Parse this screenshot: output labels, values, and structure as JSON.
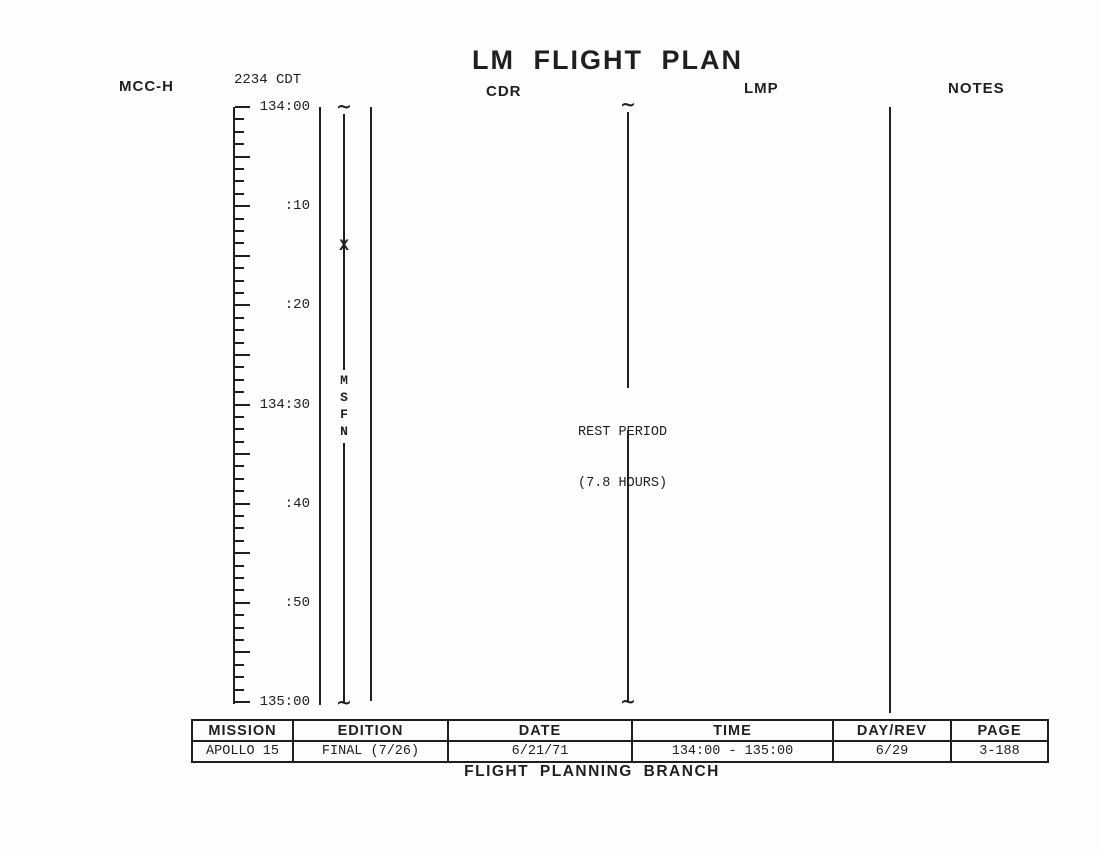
{
  "title": "LM FLIGHT PLAN",
  "header": {
    "mcch_label": "MCC-H",
    "local_time": "2234 CDT",
    "cdr_label": "CDR",
    "lmp_label": "LMP",
    "notes_label": "NOTES"
  },
  "timeline": {
    "start_label": "134:00",
    "end_label": "135:00",
    "duration_minutes": 60,
    "major_tick_minutes": 5,
    "minor_divisions_per_major": 4,
    "labels": [
      {
        "text": "134:00",
        "minutes": 0
      },
      {
        "text": ":10",
        "minutes": 10
      },
      {
        "text": ":20",
        "minutes": 20
      },
      {
        "text": "134:30",
        "minutes": 30
      },
      {
        "text": ":40",
        "minutes": 40
      },
      {
        "text": ":50",
        "minutes": 50
      },
      {
        "text": "135:00",
        "minutes": 60
      }
    ],
    "msfn": {
      "text": "MSFN",
      "station_mark": "X",
      "station_mark_minutes": 14
    },
    "rest_period": {
      "line1": "REST PERIOD",
      "line2": "(7.8 HOURS)"
    }
  },
  "footer_table": {
    "columns": [
      {
        "header": "MISSION",
        "value": "APOLLO 15"
      },
      {
        "header": "EDITION",
        "value": "FINAL (7/26)"
      },
      {
        "header": "DATE",
        "value": "6/21/71"
      },
      {
        "header": "TIME",
        "value": "134:00 - 135:00"
      },
      {
        "header": "DAY/REV",
        "value": "6/29"
      },
      {
        "header": "PAGE",
        "value": "3-188"
      }
    ]
  },
  "footer": "FLIGHT PLANNING BRANCH",
  "colors": {
    "ink": "#1f1f1f",
    "paper": "#fdfdfc"
  }
}
